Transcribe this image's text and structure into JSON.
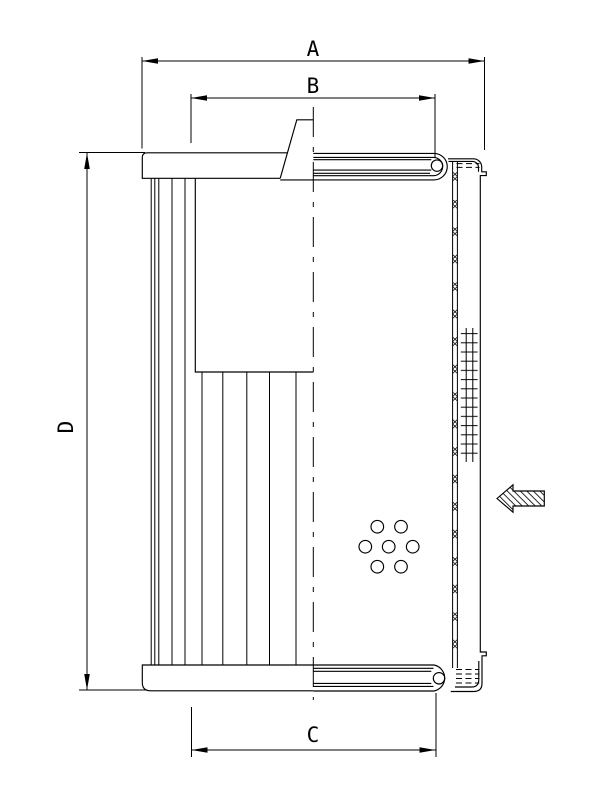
{
  "drawing": {
    "type": "filter-element-cross-section",
    "colors": {
      "line": "#000000",
      "background": "#ffffff"
    },
    "dimensions": {
      "a": "A",
      "b": "B",
      "c": "C",
      "d": "D"
    }
  }
}
